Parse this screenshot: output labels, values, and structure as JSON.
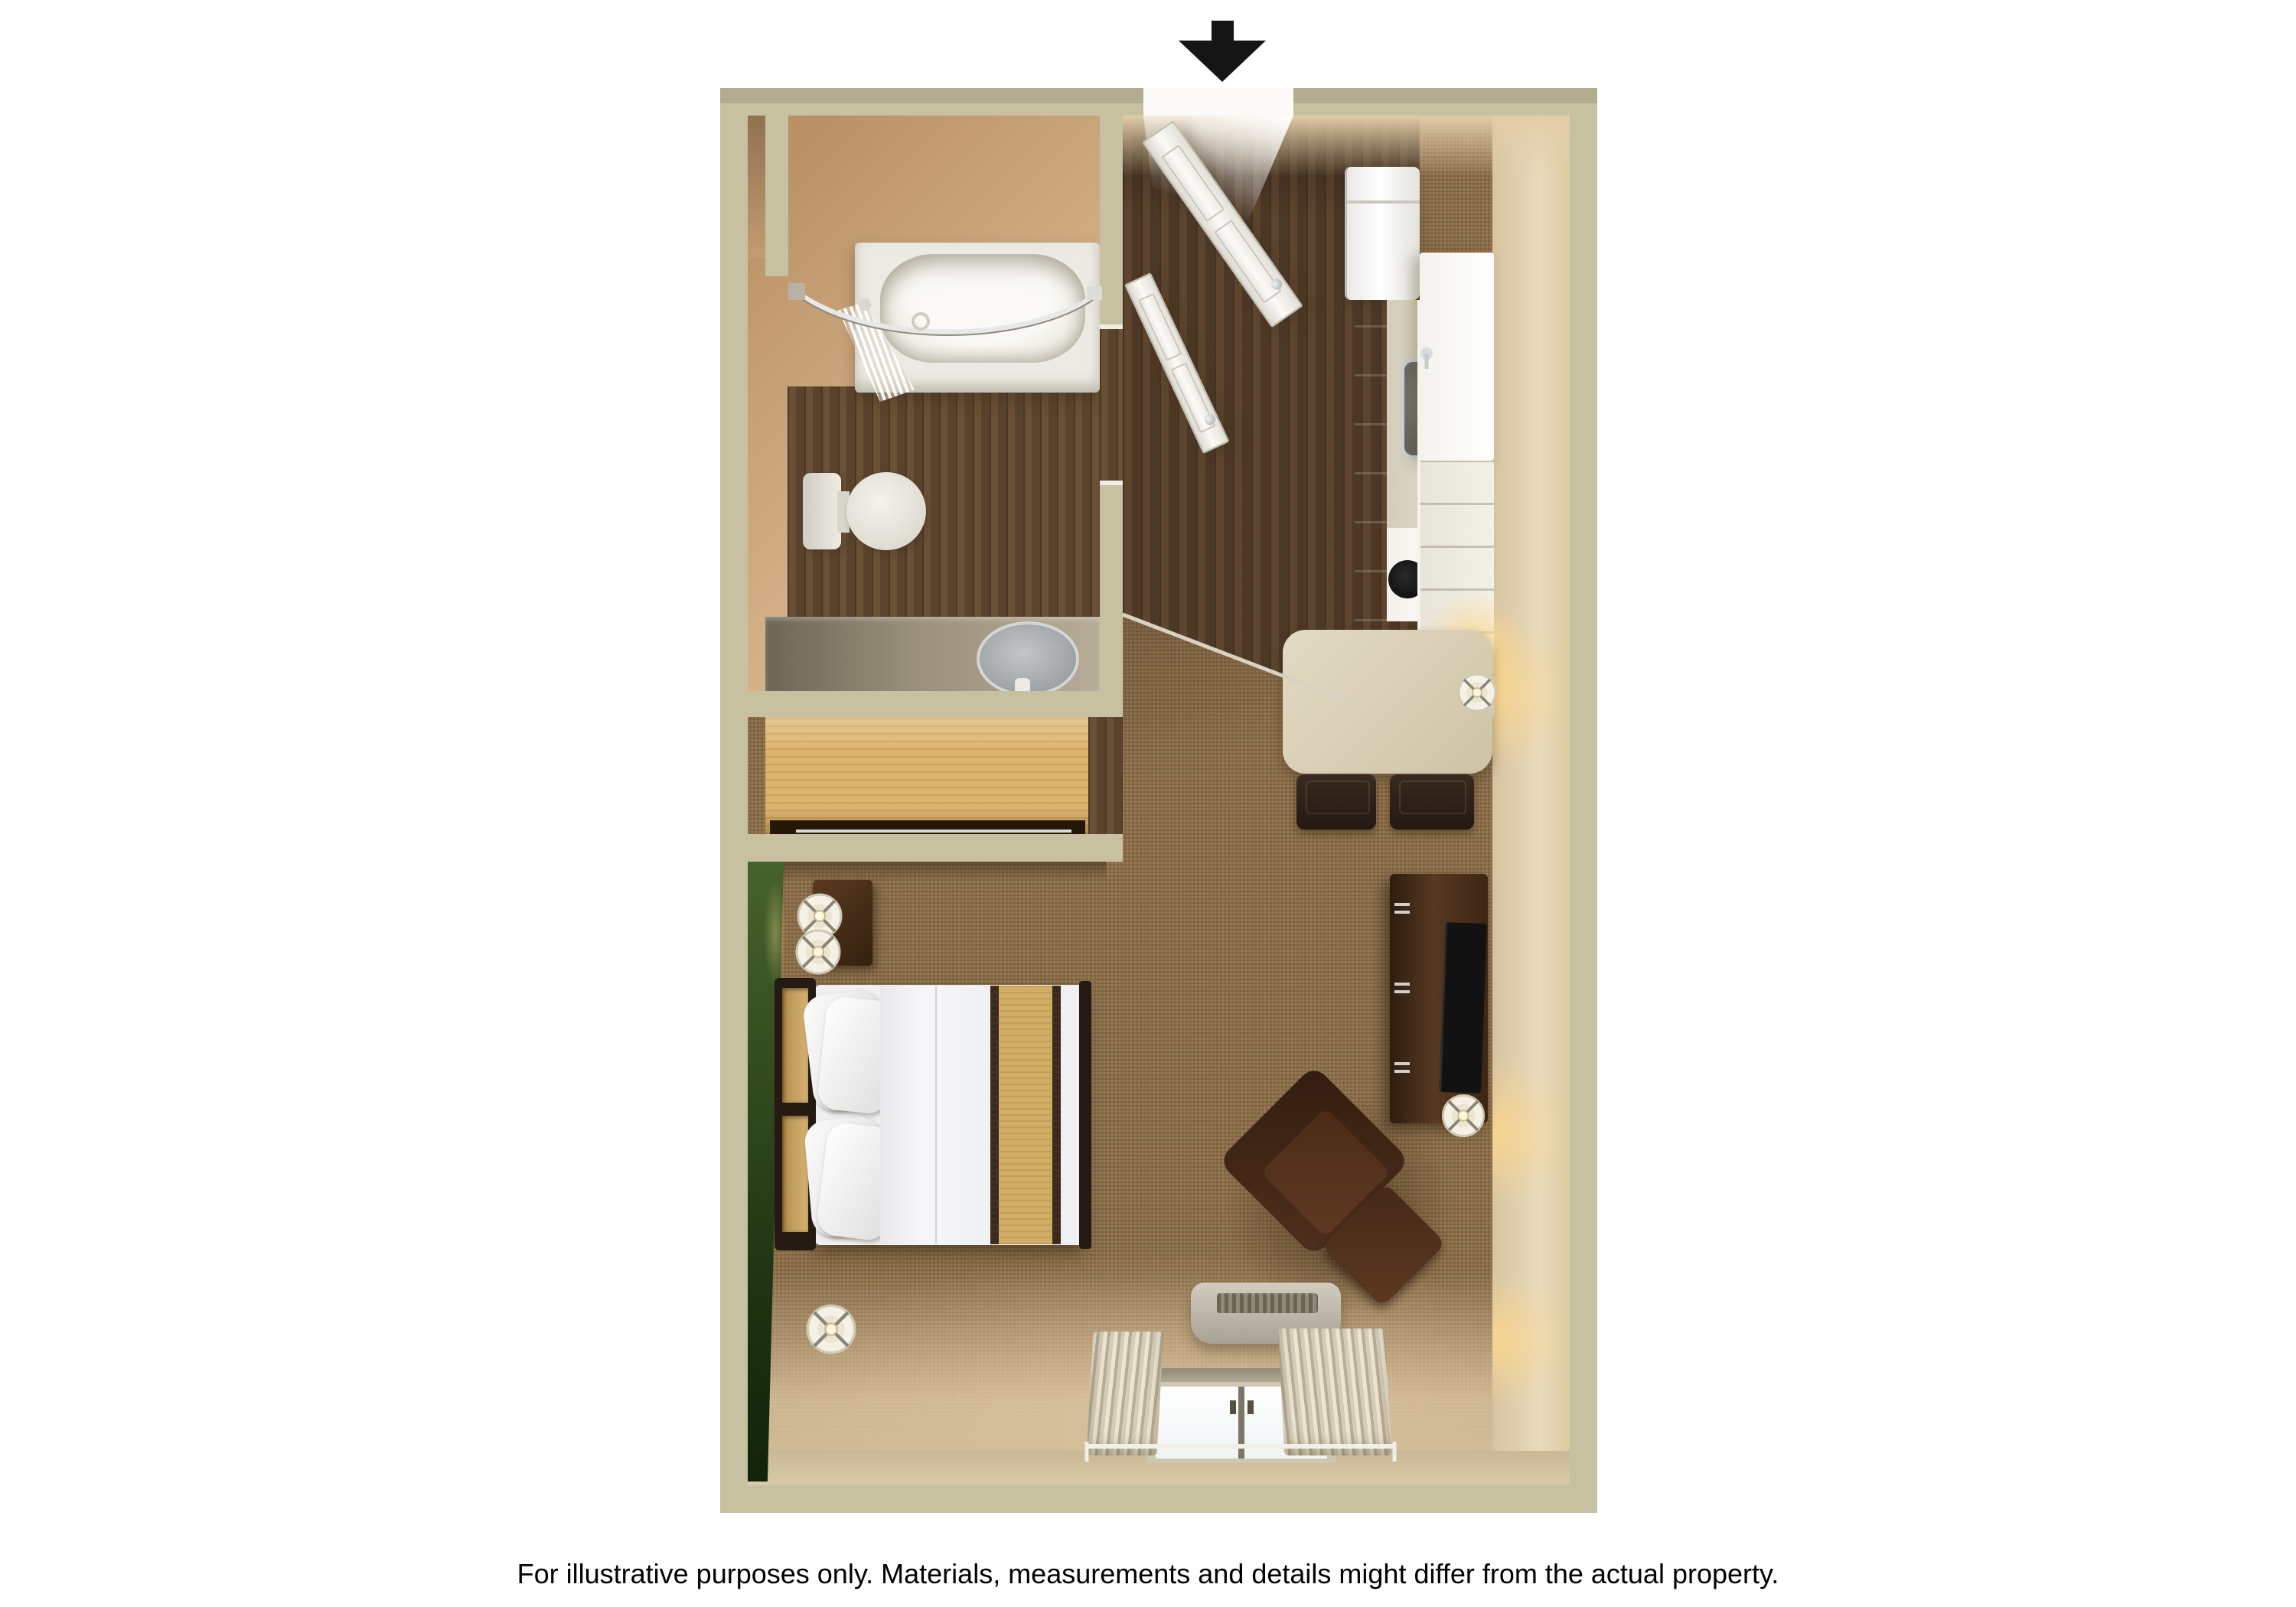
{
  "page": {
    "background": "#ffffff",
    "kind": "3d-floor-plan-rendering"
  },
  "annotations": {
    "entrance_arrow": {
      "meaning": "entrance",
      "direction": "down",
      "color": "#151515"
    },
    "disclaimer": "For illustrative purposes only.  Materials, measurements and details might differ from the actual property."
  },
  "palette": {
    "wall": "#c8c1a1",
    "wallDark": "#b3ab8b",
    "bathWallA": "#b68c62",
    "bathWallB": "#e2c6a0",
    "woodA": "#4d3826",
    "woodB": "#5a432d",
    "carpet": "#8b6e49",
    "green": "#3f5b27",
    "greenDark": "#16290e",
    "maple": "#dcb46f",
    "counterTop": "#d8d2c0",
    "vanity": "#9a907b",
    "fixtureWhite": "#f1efe8",
    "tableTop": "#d9cfb6",
    "chairBrown": "#332419",
    "furnitureWood": "#4a2e18",
    "bedding": "#f2f2f4",
    "bedStripe": "#d2ae65",
    "bedTrim": "#3a2a1e",
    "tv": "#121212",
    "ac": "#b6b0a3",
    "ink": "#151515"
  },
  "floor_plan": {
    "view": "top-down 3d studio suite",
    "rooms": [
      {
        "name": "bathroom",
        "floor": "dark wood",
        "features": [
          "bathtub with curved shower rod",
          "shower curtain",
          "toilet",
          "vanity with oval sink",
          "wall niche"
        ]
      },
      {
        "name": "closet",
        "features": [
          "light wood wardrobe"
        ]
      },
      {
        "name": "entry-kitchen",
        "floor": "dark wood",
        "features": [
          "entry door (open)",
          "bathroom door (open)",
          "refrigerator",
          "countertop with sink",
          "stove with two burners",
          "tall cabinets"
        ]
      },
      {
        "name": "dining",
        "features": [
          "table with table lamp",
          "two chairs"
        ]
      },
      {
        "name": "bedroom-living",
        "floor": "carpet",
        "accent_wall": "green",
        "features": [
          "bed with gold stripe runner",
          "headboard",
          "nightstand with two lamps",
          "floor lamp",
          "tv dresser with tv and lamp",
          "armchair with ottoman",
          "ac unit",
          "window with curtains"
        ]
      }
    ]
  }
}
